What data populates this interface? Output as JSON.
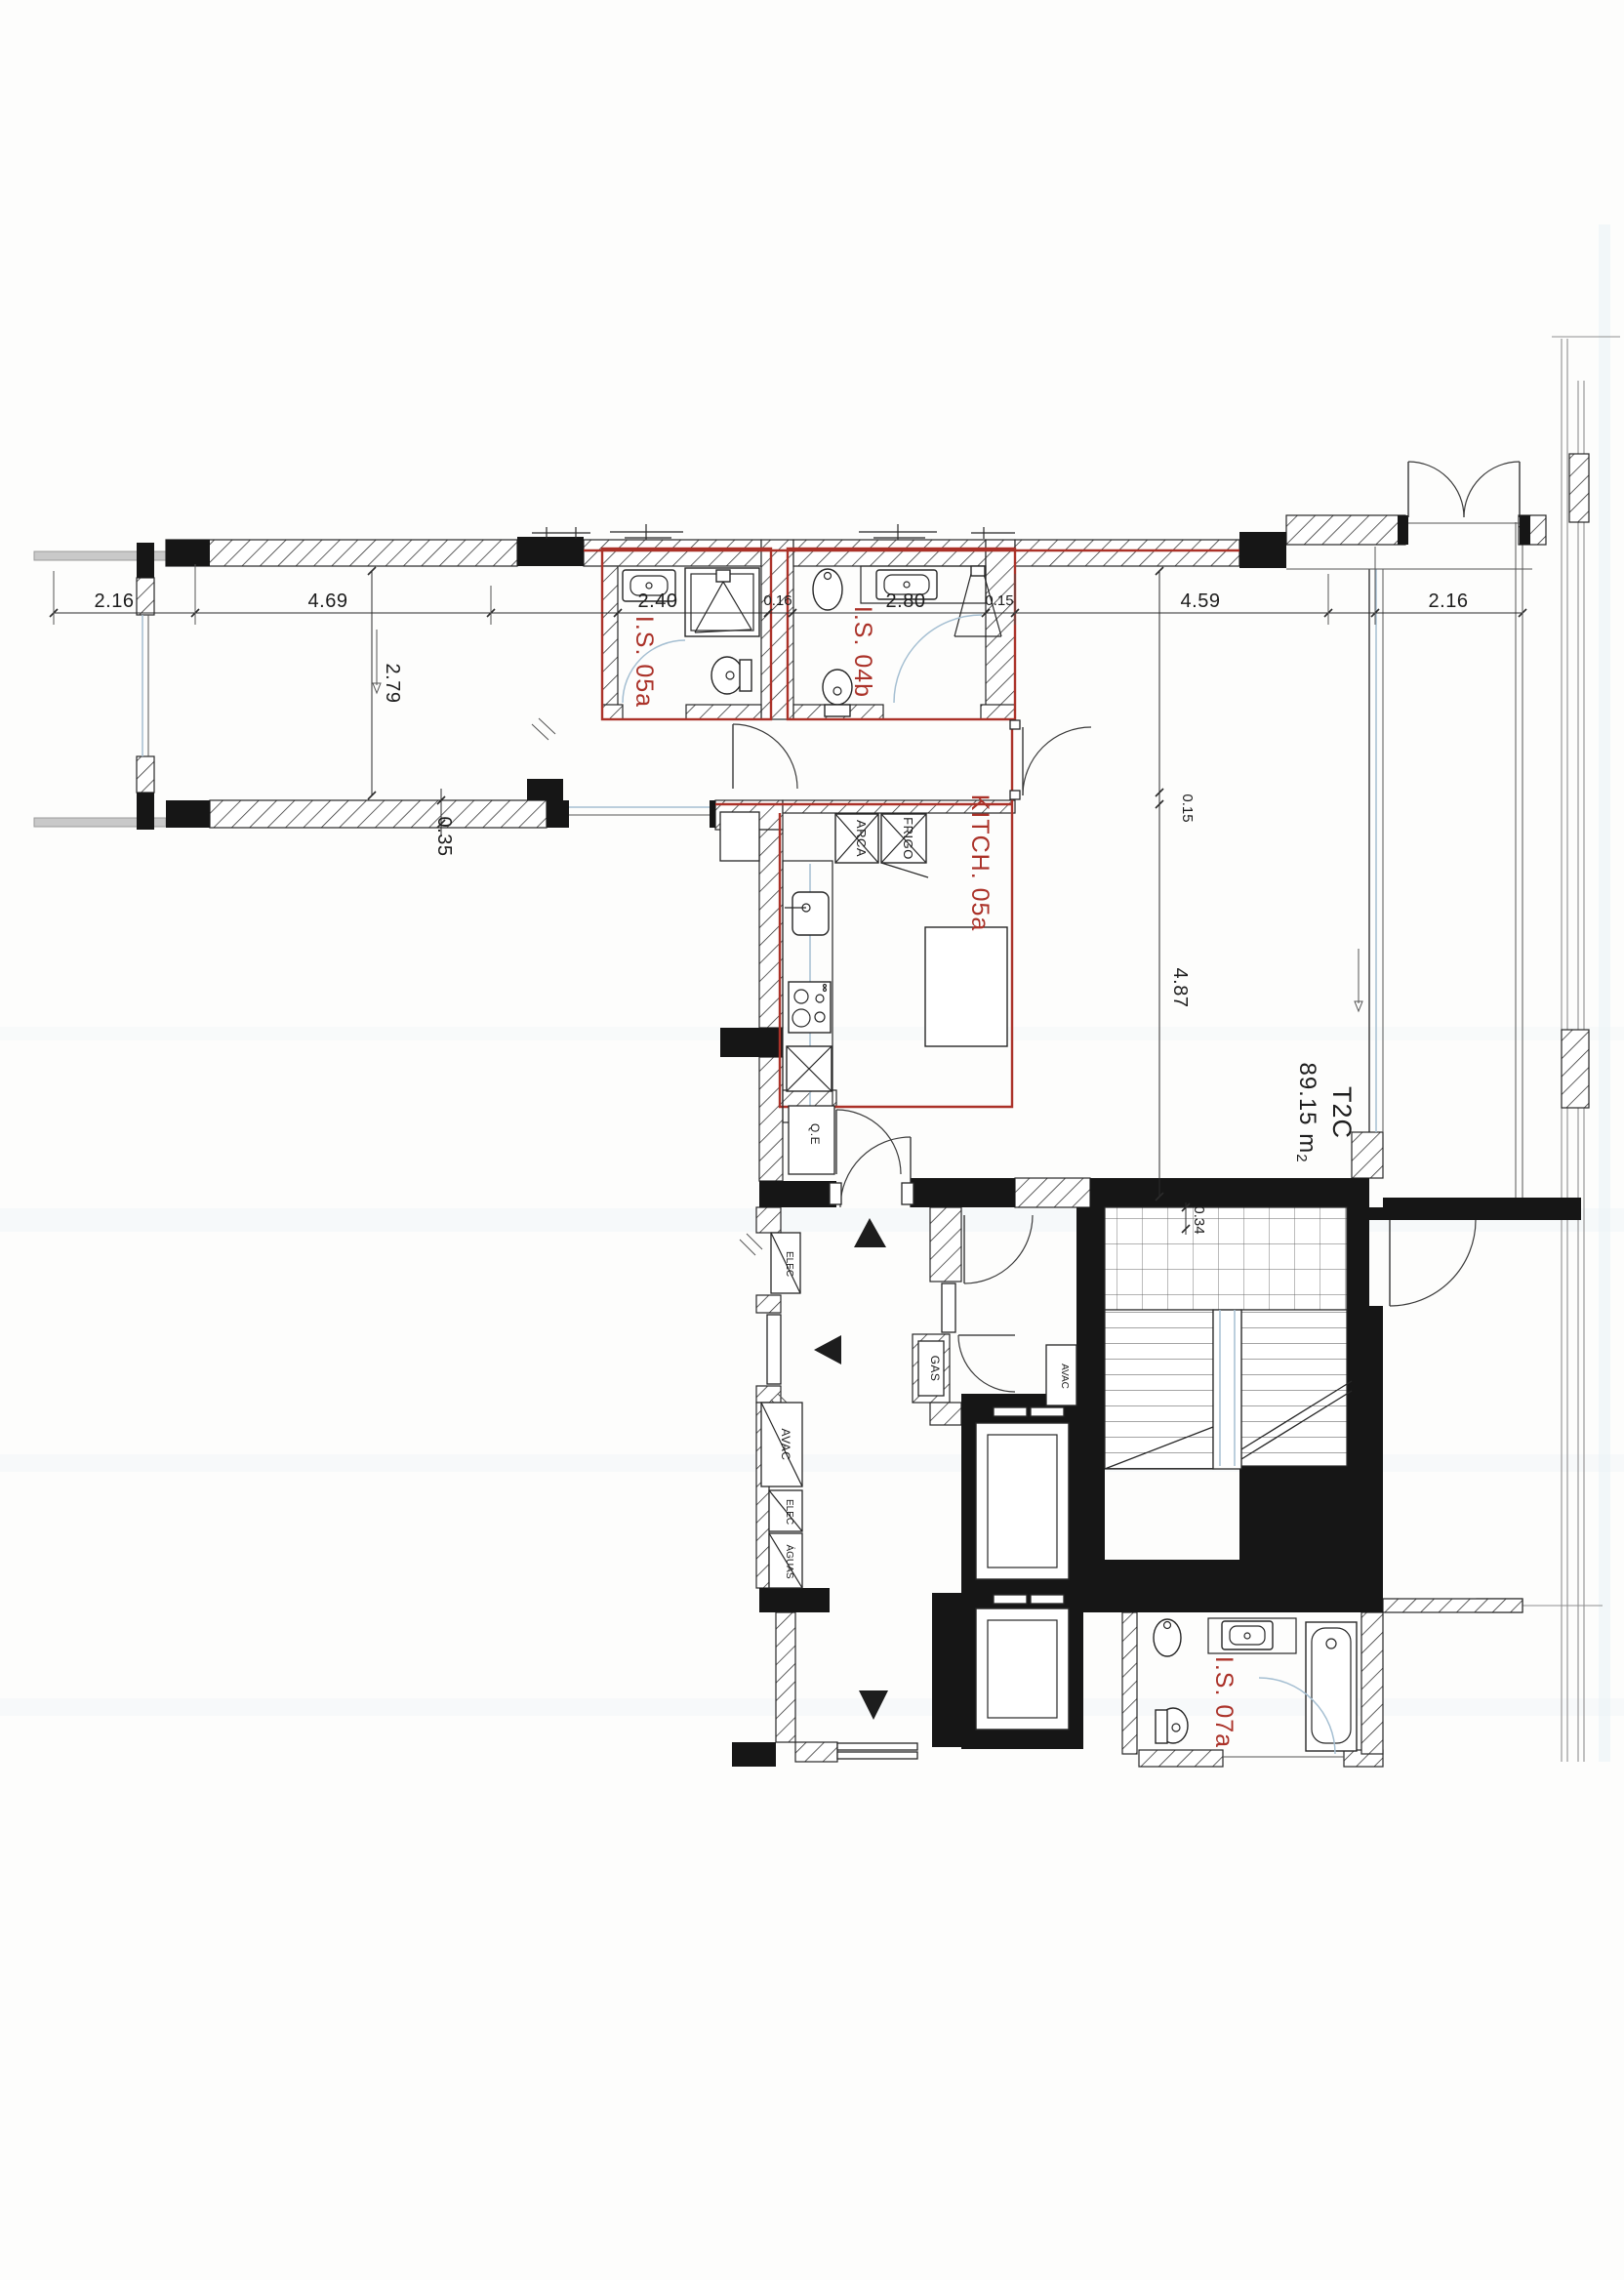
{
  "drawing": {
    "type": "architectural floor plan (scanned)",
    "unit": {
      "type": "T2C",
      "area": "89.15 m",
      "area_exp": "2"
    },
    "colors": {
      "red": "#ab3229",
      "wall": "#161616",
      "blue": "#a5bfd2"
    }
  },
  "room_labels": {
    "is05a": "I.S. 05a",
    "is04b": "I.S. 04b",
    "kitch": "KITCH. 05a",
    "is07a": "I.S. 07a"
  },
  "shafts": {
    "qe": "Q.E",
    "elec_top": "ELEC",
    "avac_left": "AVAC",
    "elec_left": "ELEC",
    "aguas": "ÁGUAS",
    "gas": "GAS",
    "avac_core": "AVAC"
  },
  "appliances": {
    "arca": "ARCA",
    "frigo": "FRIGO"
  },
  "dimensions": {
    "d216l": "2.16",
    "d469": "4.69",
    "d279": "2.79",
    "d035": "0.35",
    "d240": "2.40",
    "d016": "0.16",
    "d280": "2.80",
    "d015a": "0.15",
    "d459": "4.59",
    "d216r": "2.16",
    "d487": "4.87",
    "d015b": "0.15",
    "d034": "0.34"
  }
}
